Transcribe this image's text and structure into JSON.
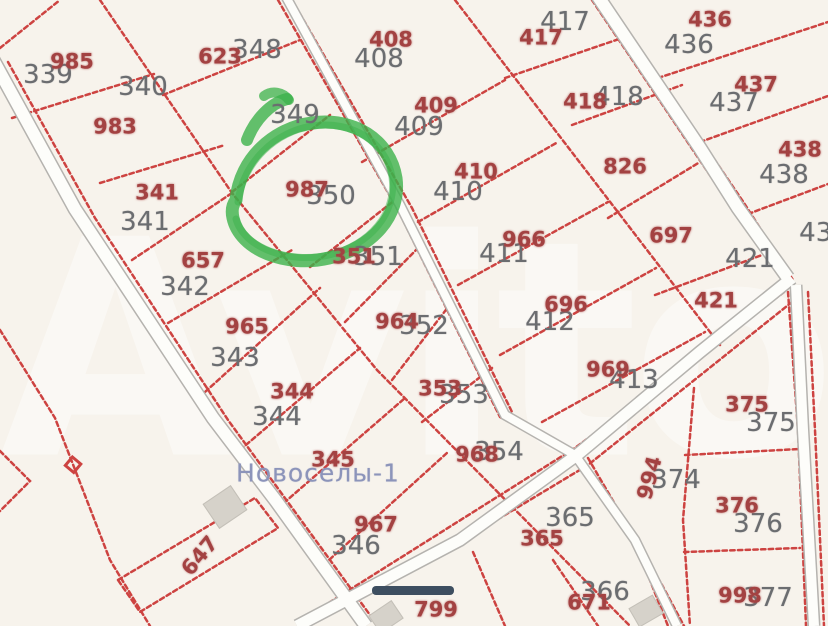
{
  "meta": {
    "app": "map-viewer",
    "settlement_label": "Новоселы-1",
    "watermark_text": "Avito"
  },
  "colors": {
    "background": "#f7f3ec",
    "parcel_line": "#cb3a38",
    "parcel_number_red": "#a34242",
    "parcel_number_gray": "#6b6d70",
    "settlement_text": "#8c94ba",
    "highlight_green": "#3cb24b",
    "road_fill": "#fdfdfa",
    "road_edge": "#b5b3af",
    "dark_bar": "#3d4e60",
    "building_fill": "#d6d2ca"
  },
  "map": {
    "highlighted_parcel": "987",
    "labels": [
      {
        "text": "339",
        "x": 48,
        "y": 75,
        "cls": "gray"
      },
      {
        "text": "340",
        "x": 143,
        "y": 87,
        "cls": "gray"
      },
      {
        "text": "348",
        "x": 257,
        "y": 50,
        "cls": "gray"
      },
      {
        "text": "349",
        "x": 295,
        "y": 115,
        "cls": "gray"
      },
      {
        "text": "341",
        "x": 145,
        "y": 222,
        "cls": "gray"
      },
      {
        "text": "342",
        "x": 185,
        "y": 287,
        "cls": "gray"
      },
      {
        "text": "343",
        "x": 235,
        "y": 358,
        "cls": "gray"
      },
      {
        "text": "344",
        "x": 277,
        "y": 417,
        "cls": "gray"
      },
      {
        "text": "346",
        "x": 356,
        "y": 546,
        "cls": "gray"
      },
      {
        "text": "350",
        "x": 331,
        "y": 196,
        "cls": "gray"
      },
      {
        "text": "351",
        "x": 378,
        "y": 257,
        "cls": "gray"
      },
      {
        "text": "352",
        "x": 424,
        "y": 326,
        "cls": "gray"
      },
      {
        "text": "353",
        "x": 464,
        "y": 395,
        "cls": "gray"
      },
      {
        "text": "354",
        "x": 499,
        "y": 452,
        "cls": "gray"
      },
      {
        "text": "408",
        "x": 379,
        "y": 59,
        "cls": "gray"
      },
      {
        "text": "409",
        "x": 419,
        "y": 127,
        "cls": "gray"
      },
      {
        "text": "410",
        "x": 458,
        "y": 192,
        "cls": "gray"
      },
      {
        "text": "411",
        "x": 504,
        "y": 254,
        "cls": "gray"
      },
      {
        "text": "412",
        "x": 550,
        "y": 322,
        "cls": "gray"
      },
      {
        "text": "413",
        "x": 634,
        "y": 380,
        "cls": "gray"
      },
      {
        "text": "417",
        "x": 565,
        "y": 22,
        "cls": "gray"
      },
      {
        "text": "418",
        "x": 619,
        "y": 97,
        "cls": "gray"
      },
      {
        "text": "421",
        "x": 750,
        "y": 259,
        "cls": "gray"
      },
      {
        "text": "436",
        "x": 689,
        "y": 45,
        "cls": "gray"
      },
      {
        "text": "437",
        "x": 734,
        "y": 103,
        "cls": "gray"
      },
      {
        "text": "438",
        "x": 784,
        "y": 175,
        "cls": "gray"
      },
      {
        "text": "439",
        "x": 824,
        "y": 233,
        "cls": "gray"
      },
      {
        "text": "374",
        "x": 676,
        "y": 480,
        "cls": "gray"
      },
      {
        "text": "375",
        "x": 771,
        "y": 423,
        "cls": "gray"
      },
      {
        "text": "376",
        "x": 758,
        "y": 524,
        "cls": "gray"
      },
      {
        "text": "377",
        "x": 768,
        "y": 598,
        "cls": "gray"
      },
      {
        "text": "365",
        "x": 570,
        "y": 518,
        "cls": "gray"
      },
      {
        "text": "366",
        "x": 605,
        "y": 592,
        "cls": "gray"
      },
      {
        "text": "985",
        "x": 72,
        "y": 62,
        "cls": "red"
      },
      {
        "text": "983",
        "x": 115,
        "y": 127,
        "cls": "red"
      },
      {
        "text": "623",
        "x": 220,
        "y": 57,
        "cls": "red"
      },
      {
        "text": "341",
        "x": 157,
        "y": 193,
        "cls": "red"
      },
      {
        "text": "657",
        "x": 203,
        "y": 261,
        "cls": "red"
      },
      {
        "text": "965",
        "x": 247,
        "y": 327,
        "cls": "red"
      },
      {
        "text": "344",
        "x": 292,
        "y": 392,
        "cls": "red"
      },
      {
        "text": "345",
        "x": 333,
        "y": 460,
        "cls": "red"
      },
      {
        "text": "967",
        "x": 376,
        "y": 525,
        "cls": "red"
      },
      {
        "text": "987",
        "x": 307,
        "y": 190,
        "cls": "red"
      },
      {
        "text": "351",
        "x": 354,
        "y": 257,
        "cls": "red"
      },
      {
        "text": "964",
        "x": 397,
        "y": 322,
        "cls": "red"
      },
      {
        "text": "353",
        "x": 440,
        "y": 389,
        "cls": "red"
      },
      {
        "text": "968",
        "x": 477,
        "y": 455,
        "cls": "red"
      },
      {
        "text": "408",
        "x": 391,
        "y": 40,
        "cls": "red"
      },
      {
        "text": "409",
        "x": 436,
        "y": 106,
        "cls": "red"
      },
      {
        "text": "410",
        "x": 476,
        "y": 172,
        "cls": "red"
      },
      {
        "text": "966",
        "x": 524,
        "y": 240,
        "cls": "red"
      },
      {
        "text": "696",
        "x": 566,
        "y": 305,
        "cls": "red"
      },
      {
        "text": "969",
        "x": 608,
        "y": 370,
        "cls": "red"
      },
      {
        "text": "417",
        "x": 541,
        "y": 38,
        "cls": "red"
      },
      {
        "text": "418",
        "x": 585,
        "y": 102,
        "cls": "red"
      },
      {
        "text": "826",
        "x": 625,
        "y": 167,
        "cls": "red"
      },
      {
        "text": "697",
        "x": 671,
        "y": 236,
        "cls": "red"
      },
      {
        "text": "421",
        "x": 716,
        "y": 301,
        "cls": "red"
      },
      {
        "text": "436",
        "x": 710,
        "y": 20,
        "cls": "red"
      },
      {
        "text": "437",
        "x": 756,
        "y": 85,
        "cls": "red"
      },
      {
        "text": "438",
        "x": 800,
        "y": 150,
        "cls": "red"
      },
      {
        "text": "375",
        "x": 747,
        "y": 405,
        "cls": "red"
      },
      {
        "text": "376",
        "x": 737,
        "y": 506,
        "cls": "red"
      },
      {
        "text": "998",
        "x": 740,
        "y": 596,
        "cls": "red"
      },
      {
        "text": "671",
        "x": 589,
        "y": 603,
        "cls": "red"
      },
      {
        "text": "365",
        "x": 542,
        "y": 539,
        "cls": "red"
      },
      {
        "text": "799",
        "x": 436,
        "y": 610,
        "cls": "red"
      },
      {
        "text": "647",
        "x": 200,
        "y": 556,
        "cls": "red",
        "rot": -50
      },
      {
        "text": "994",
        "x": 650,
        "y": 478,
        "cls": "red",
        "rot": -75
      }
    ]
  }
}
